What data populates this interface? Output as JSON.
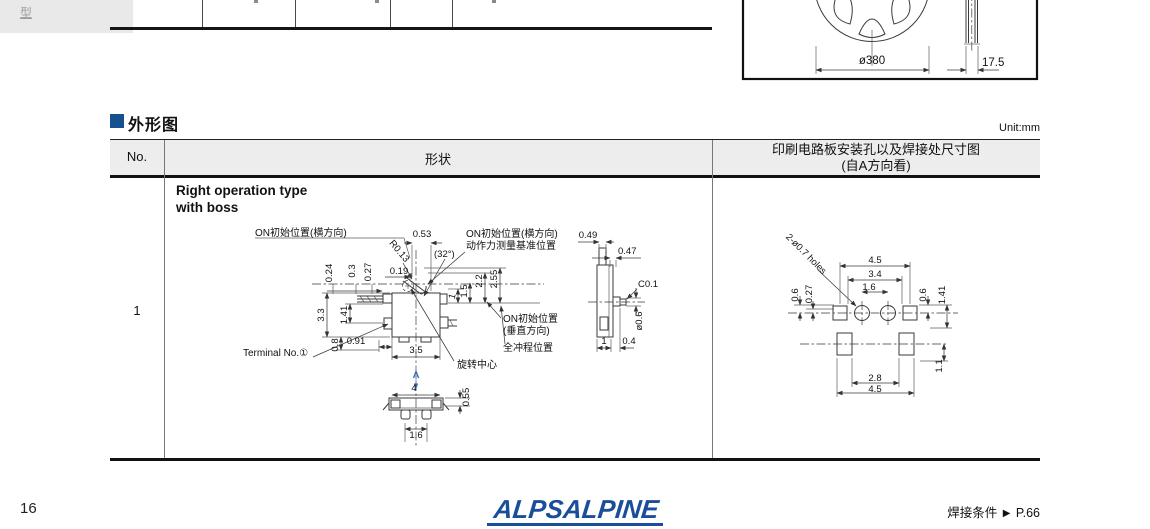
{
  "chrome": {
    "side_tab": "型",
    "unit": "Unit:mm"
  },
  "reel": {
    "diameter": "ø380",
    "thickness": "17.5"
  },
  "section": {
    "title": "外形图"
  },
  "table": {
    "col_no": "No.",
    "col_shape": "形状",
    "col_pcb_1": "印刷电路板安装孔以及焊接处尺寸图",
    "col_pcb_2": "(自A方向看)",
    "row_no": "1",
    "variant_1": "Right operation type",
    "variant_2": "with boss"
  },
  "shape": {
    "on_h": "ON初始位置(横方向)",
    "d053": "0.53",
    "r013": "R0.13",
    "a32": "(32°)",
    "on_h_ref_1": "ON初始位置(横方向)",
    "on_h_ref_2": "动作力测量基准位置",
    "d019": "0.19",
    "d024": "0.24",
    "d03": "0.3",
    "d027": "0.27",
    "d33": "3.3",
    "d141": "1.41",
    "d08": "0.8",
    "d091": "0.91",
    "d35": "3.5",
    "terminal": "Terminal No.①",
    "rot_center": "旋转中心",
    "d1": "1",
    "d15": "1.5",
    "d22": "2.2",
    "d255": "2.55",
    "on_v_1": "ON初始位置",
    "on_v_2": "(垂直方向)",
    "full_stroke": "全冲程位置",
    "view_a": "A",
    "d4": "4",
    "d055": "0.55",
    "d16": "1.6",
    "d049": "0.49",
    "d047": "0.47",
    "c01": "C0.1",
    "dia06": "ø0.6",
    "d1b": "1",
    "d04": "0.4"
  },
  "pcb": {
    "holes": "2-ø0.7 holes",
    "d45t": "4.5",
    "d34": "3.4",
    "d16": "1.6",
    "d06l": "0.6",
    "d027": "0.27",
    "d06r": "0.6",
    "d141": "1.41",
    "d11": "1.1",
    "d28": "2.8",
    "d45b": "4.5"
  },
  "footer": {
    "page": "16",
    "logo": "ALPSALPINE",
    "solder": "焊接条件",
    "arrow": "▶",
    "solder_page": "P.66"
  },
  "colors": {
    "accent_blue": "#15508f",
    "logo_blue": "#1a4e9b",
    "view_marker_blue": "#3a6ab0",
    "table_header_bg": "#ededed"
  }
}
